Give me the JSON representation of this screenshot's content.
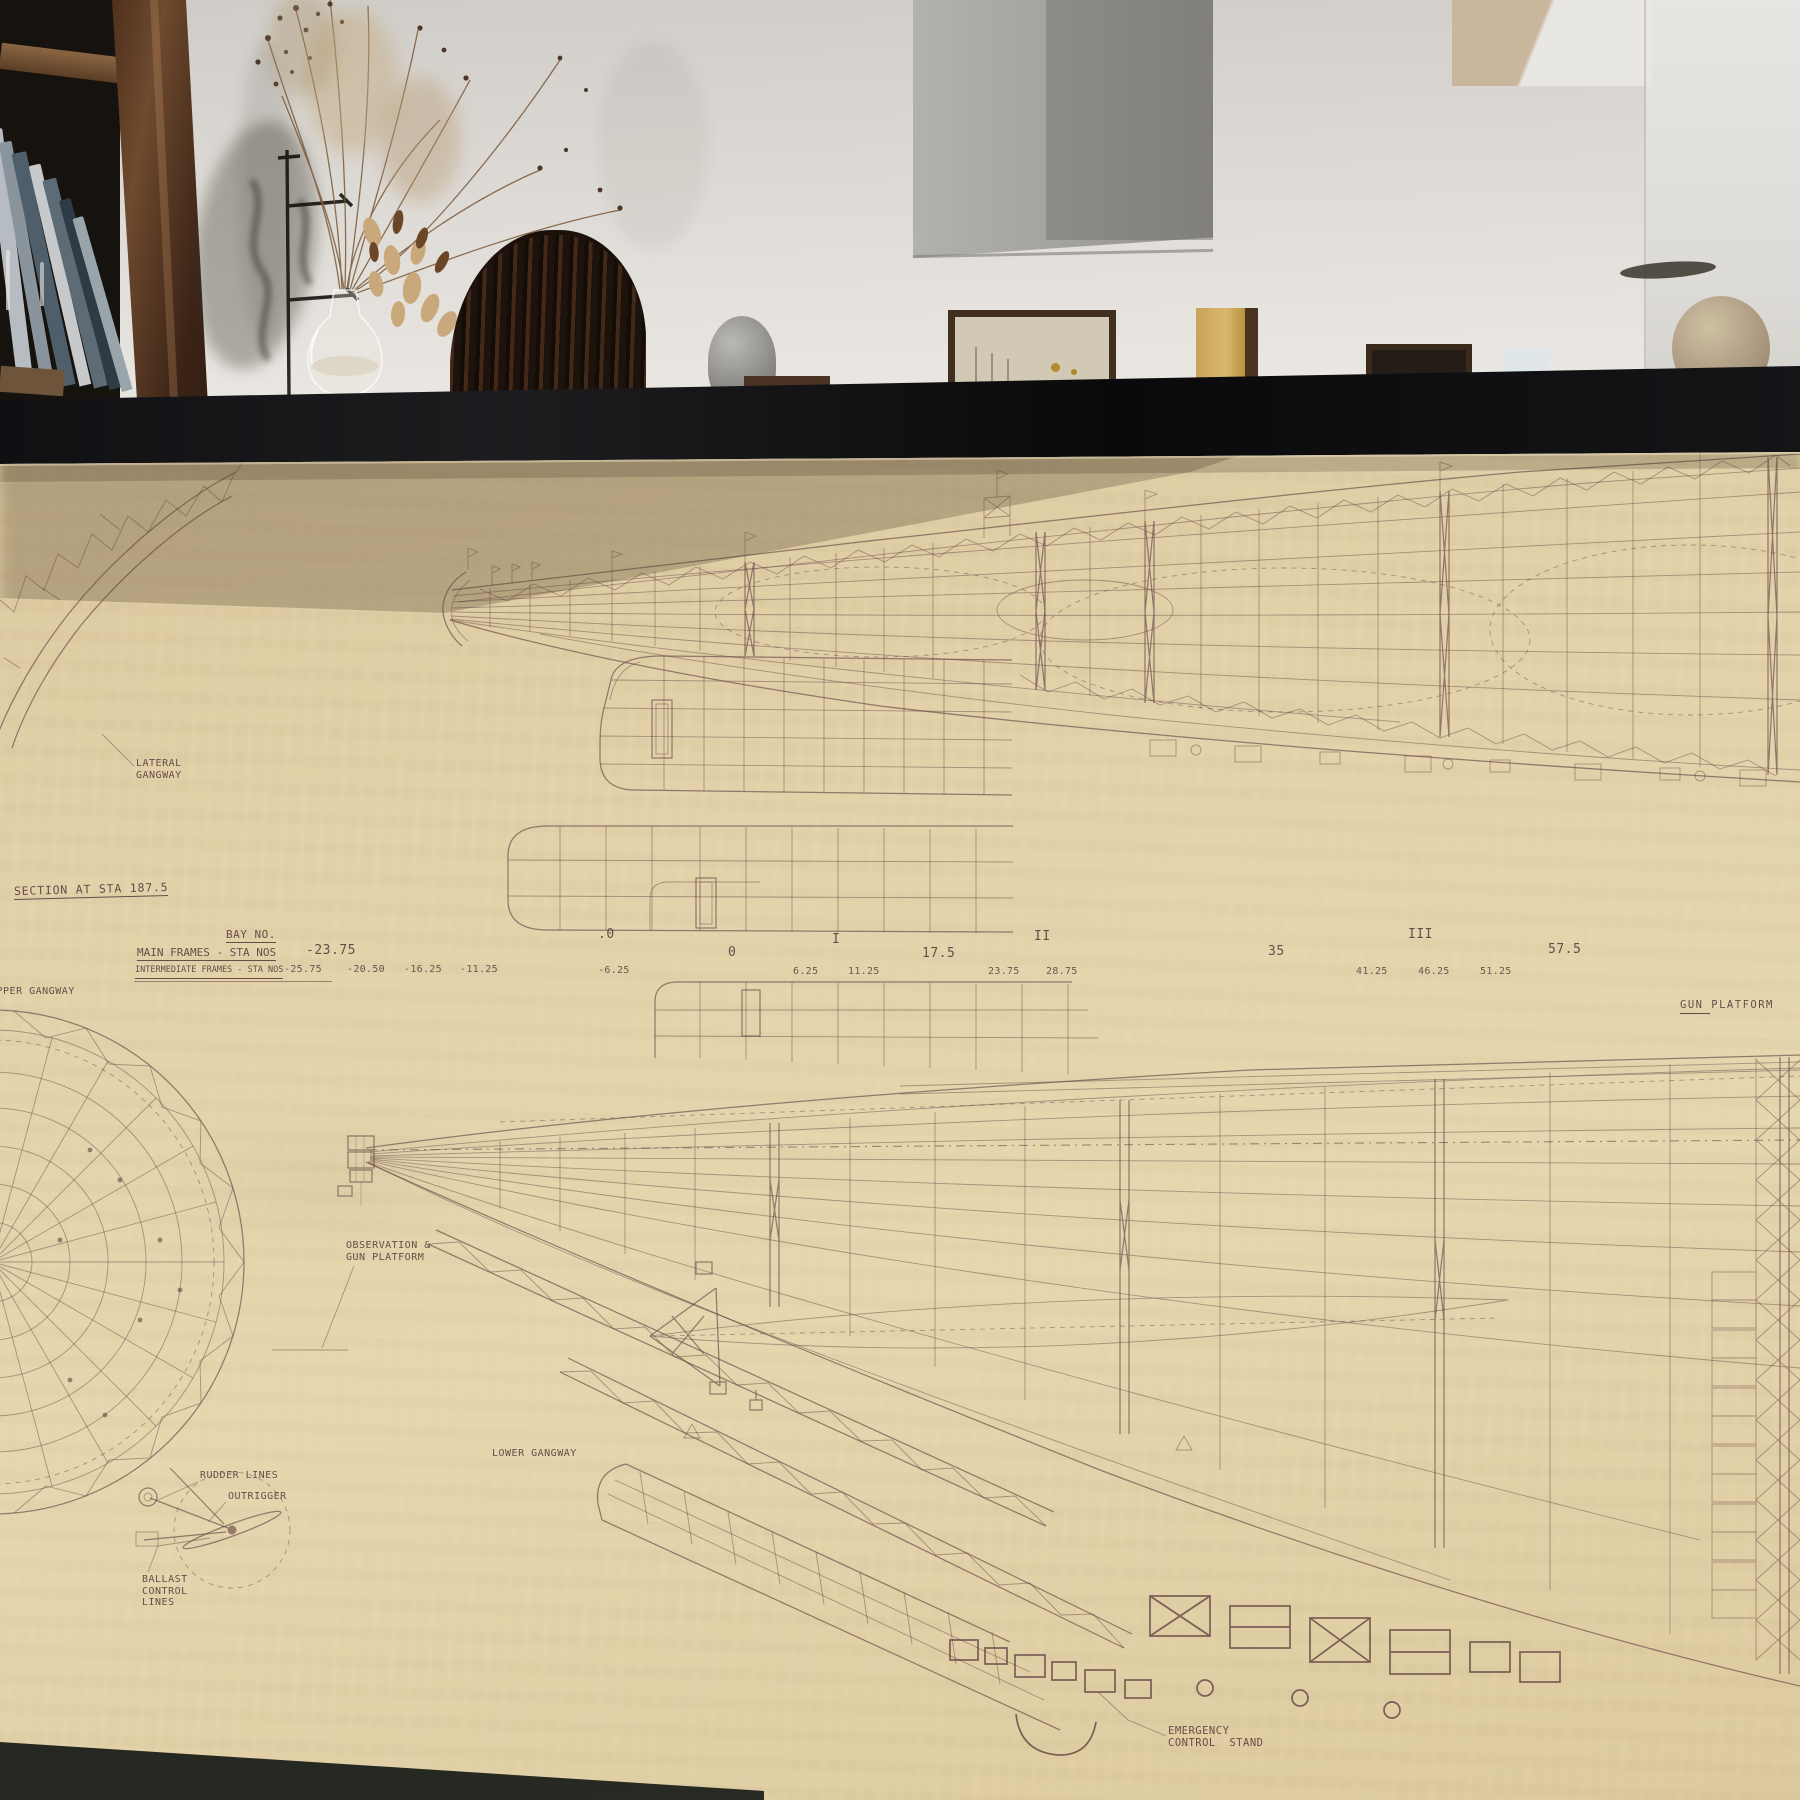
{
  "colors": {
    "paper": "#e0cda4",
    "ink": "#6a4c49",
    "frame": "#101013",
    "wall": "#e2dfda"
  },
  "drawing": {
    "section_label": "SECTION AT STA 187.5",
    "frame_table": {
      "bay_header": "BAY NO.",
      "main_header": "MAIN FRAMES - STA NOS",
      "intermediate_header": "INTERMEDIATE FRAMES - STA NOS",
      "bays": [
        ".0",
        "I",
        "II",
        "III"
      ],
      "main_stations": [
        "-23.75",
        "0",
        "17.5",
        "35",
        "57.5"
      ],
      "intermediate_stations": [
        "-25.75",
        "-20.50",
        "-16.25",
        "-11.25",
        "-6.25",
        "6.25",
        "11.25",
        "23.75",
        "28.75",
        "41.25",
        "46.25",
        "51.25"
      ]
    },
    "labels": {
      "lateral_gangway_1": "LATERAL",
      "lateral_gangway_2": "GANGWAY",
      "upper_gangway": "UPPER GANGWAY",
      "gun_platform": "GUN PLATFORM",
      "observation_1": "OBSERVATION &",
      "observation_2": "GUN PLATFORM",
      "lower_gangway": "LOWER GANGWAY",
      "rudder_lines": "RUDDER LINES",
      "outrigger": "OUTRIGGER",
      "ballast_1": "BALLAST",
      "ballast_2": "CONTROL",
      "ballast_3": "LINES",
      "emergency_1": "EMERGENCY",
      "emergency_2": "CONTROL  STAND"
    }
  }
}
